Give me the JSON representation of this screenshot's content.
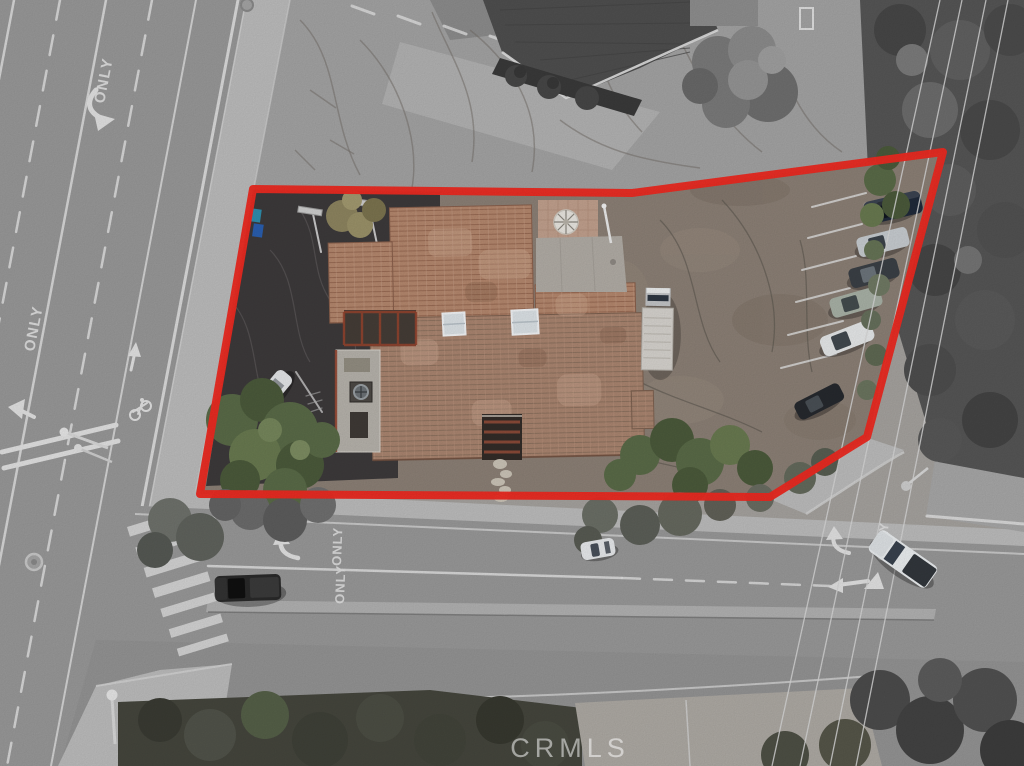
{
  "scene": {
    "kind": "aerial drone photo of commercial property listing",
    "note": "grayscale surroundings with property shown in color inside red boundary"
  },
  "labels": {
    "lane_only": "ONLY",
    "watermark": "CRMLS"
  },
  "boundary": {
    "points": "253,189 632,193 943,152 867,437 770,497 200,494",
    "color": "#ee2a21",
    "stroke_width": "8"
  },
  "colors": {
    "boundary": "#ee2a21",
    "roof": "#b5886e",
    "roof_line": "#9a6c55",
    "roof_light": "#c9a089",
    "roof2": "#aa8570",
    "roof2_line": "#8f7360",
    "dirt": "#8c8076",
    "asphalt": "#3d3a3b",
    "road": "#999999",
    "walk": "#bdbdbd",
    "mark": "#e3e3e3",
    "green1": "#5a6b48",
    "green2": "#4b5a3b",
    "green3": "#697a50",
    "gray_tree": "#565656",
    "pad": "#b2ada6",
    "patio": "#c2a18e",
    "deck": "#b7b3ac",
    "rail": "#93442f"
  },
  "vehicles": {
    "parking_row": [
      {
        "name": "suv-dark-blue",
        "color": "#202a3a"
      },
      {
        "name": "sedan-silver",
        "color": "#c8cdd1"
      },
      {
        "name": "sedan-dark-gray",
        "color": "#3b4046"
      },
      {
        "name": "sedan-sage-silver",
        "color": "#a9b2a7"
      },
      {
        "name": "sedan-white",
        "color": "#e7e9ea"
      },
      {
        "name": "sedan-dark",
        "color": "#26292e"
      }
    ],
    "property": [
      {
        "name": "car-white",
        "color": "#e5e7e9"
      },
      {
        "name": "box-truck-white",
        "color": "#d7d4cf"
      }
    ],
    "street": [
      {
        "name": "pickup-dark",
        "color": "#2a2a2a"
      },
      {
        "name": "car-white-road",
        "color": "#e8eaec"
      },
      {
        "name": "pickup-white-turning",
        "color": "#eceff1"
      }
    ]
  }
}
